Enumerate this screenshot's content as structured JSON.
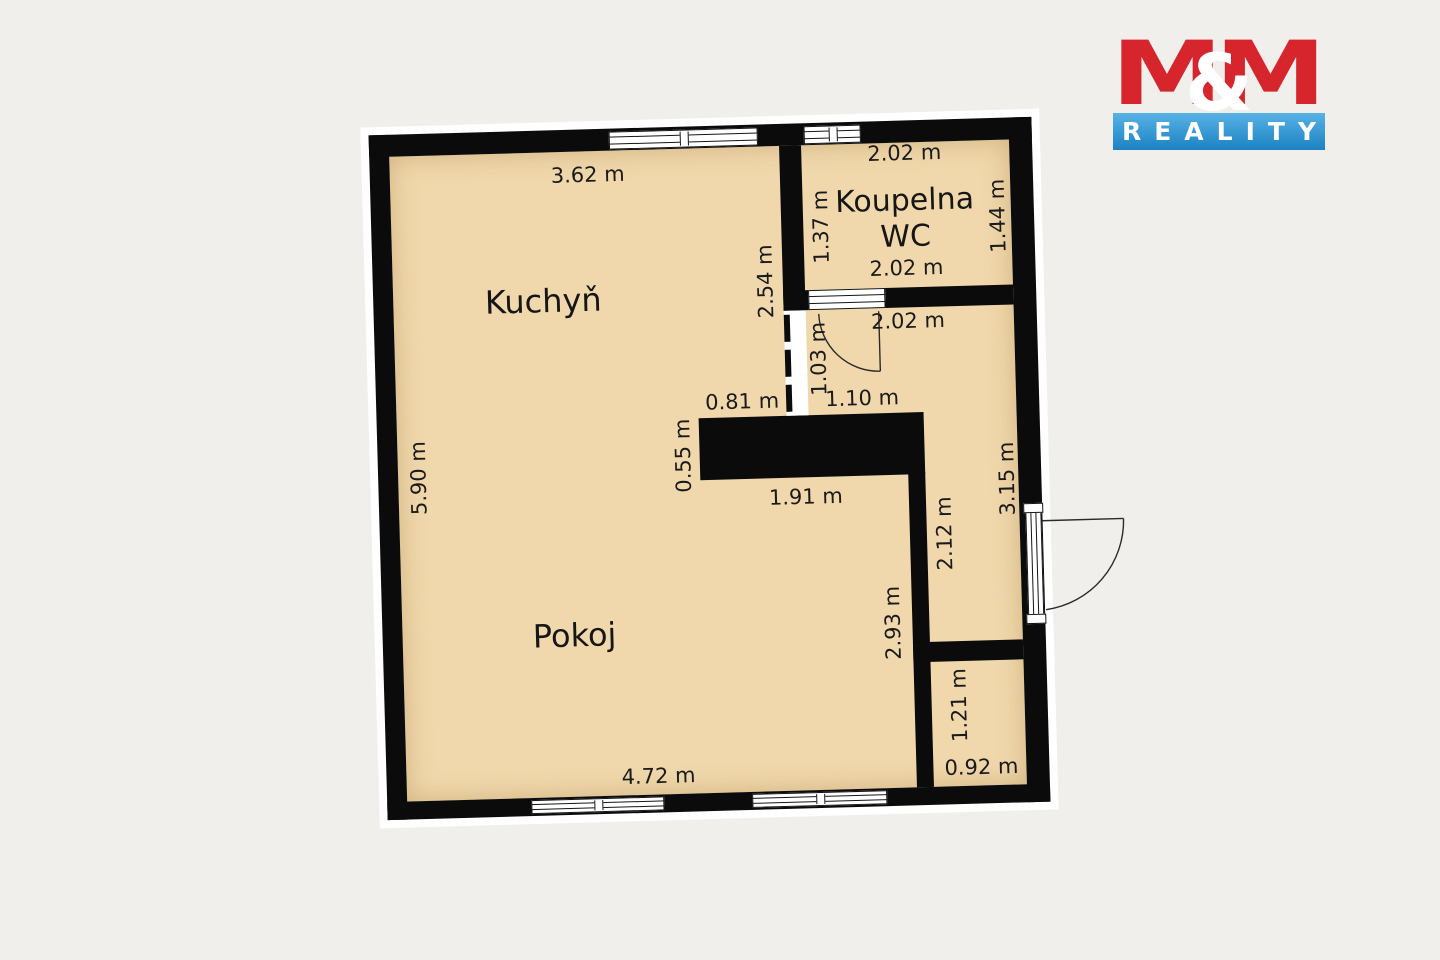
{
  "page": {
    "background_color": "#f0efeb"
  },
  "logo": {
    "m_left": "M",
    "ampersand": "&",
    "m_right": "M",
    "subtitle": "REALITY",
    "red": "#d6252c",
    "blue_top": "#58b2e6",
    "blue_bottom": "#1b82c2"
  },
  "floorplan": {
    "colors": {
      "wall": "#0b0b0b",
      "floor": "#f0d8ac",
      "paper": "#ffffff"
    },
    "rooms": {
      "kitchen": "Kuchyň",
      "living": "Pokoj",
      "bath_line1": "Koupelna",
      "bath_line2": "WC"
    },
    "dims": [
      {
        "id": "kitchen-top-width",
        "text": "3.62 m"
      },
      {
        "id": "bath-top-width",
        "text": "2.02 m"
      },
      {
        "id": "bath-left-height",
        "text": "1.37 m"
      },
      {
        "id": "bath-right-height",
        "text": "1.44 m"
      },
      {
        "id": "bath-bottom-width",
        "text": "2.02 m"
      },
      {
        "id": "kitchen-right-height",
        "text": "2.54 m"
      },
      {
        "id": "hall-top-width",
        "text": "2.02 m"
      },
      {
        "id": "hall-opening-height",
        "text": "1.03 m"
      },
      {
        "id": "core-top-left",
        "text": "0.81 m"
      },
      {
        "id": "core-top-right",
        "text": "1.10 m"
      },
      {
        "id": "core-left-height",
        "text": "0.55 m"
      },
      {
        "id": "core-bottom-width",
        "text": "1.91 m"
      },
      {
        "id": "hall-right-height",
        "text": "3.15 m"
      },
      {
        "id": "hall-mid-height",
        "text": "2.12 m"
      },
      {
        "id": "left-wall-height",
        "text": "5.90 m"
      },
      {
        "id": "room-right-height",
        "text": "2.93 m"
      },
      {
        "id": "closet-height",
        "text": "1.21 m"
      },
      {
        "id": "room-bottom-width",
        "text": "4.72 m"
      },
      {
        "id": "closet-width",
        "text": "0.92 m"
      }
    ]
  }
}
